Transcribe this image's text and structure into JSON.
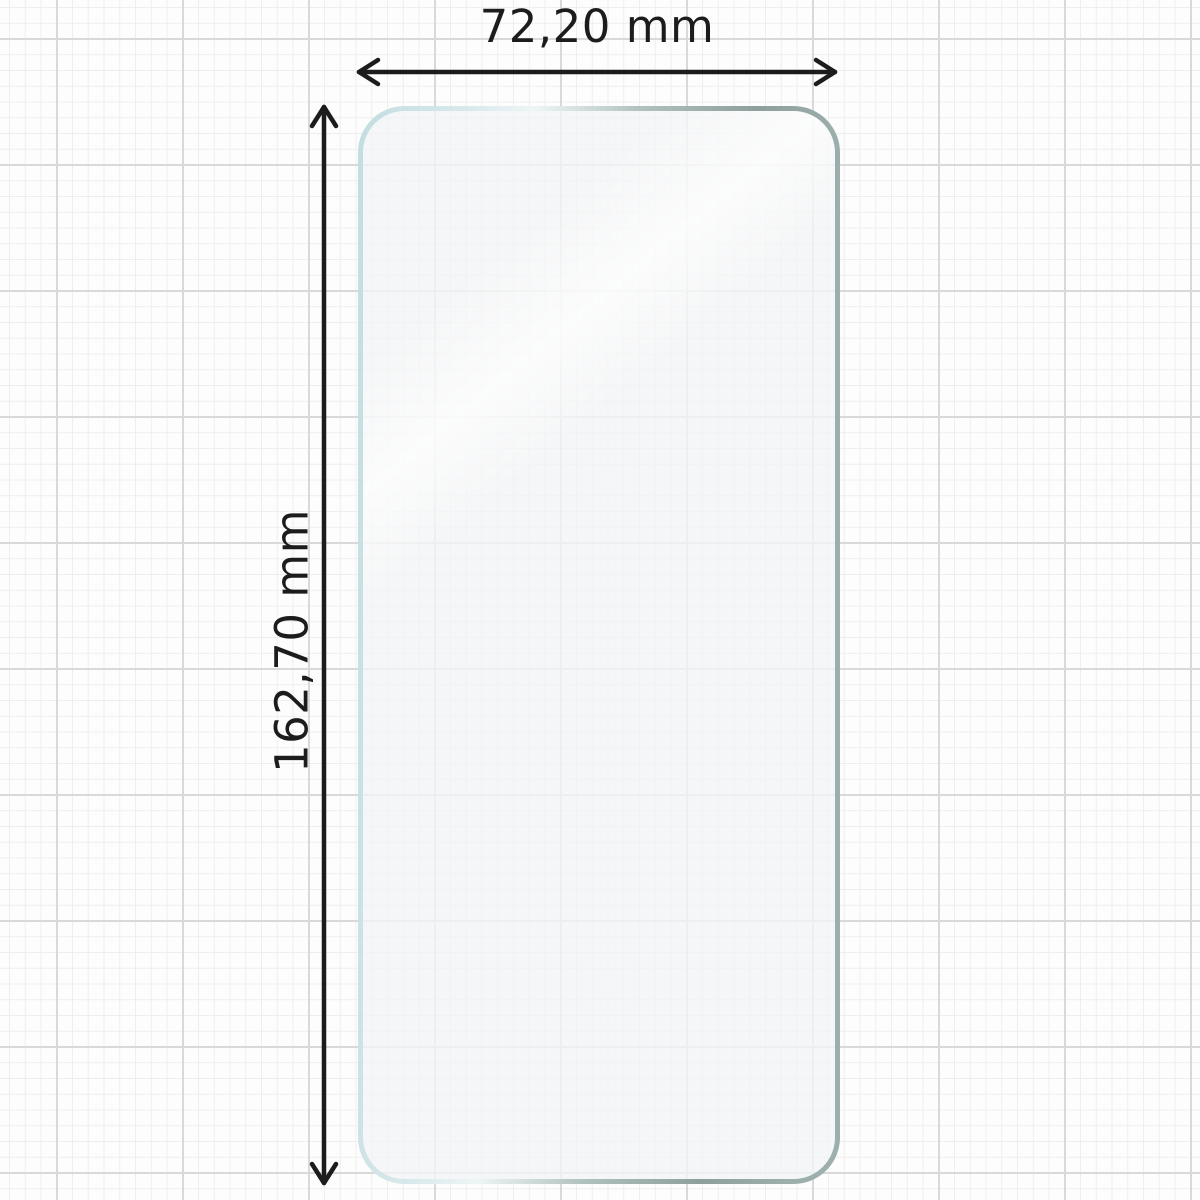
{
  "diagram": {
    "type": "dimension-diagram",
    "subject": "phone screen protector film on graph paper",
    "width_dimension": {
      "label": "72,20 mm",
      "value_mm": 72.2,
      "arrow_orientation": "horizontal"
    },
    "height_dimension": {
      "label": "162,70 mm",
      "value_mm": 162.7,
      "arrow_orientation": "vertical"
    }
  },
  "colors": {
    "page_background": "#fdfdfd",
    "grid_minor_line": "#eeeeee",
    "grid_major_line": "#d9d9d9",
    "dimension_arrow": "#1c1c1c",
    "label_text": "#1c1c1c",
    "glass_edge_teal": "#c3dde1",
    "glass_edge_glint": "#eef5f6",
    "glass_edge_gray": "#8da09d",
    "glass_surface_tint": "#f3f4f6"
  }
}
